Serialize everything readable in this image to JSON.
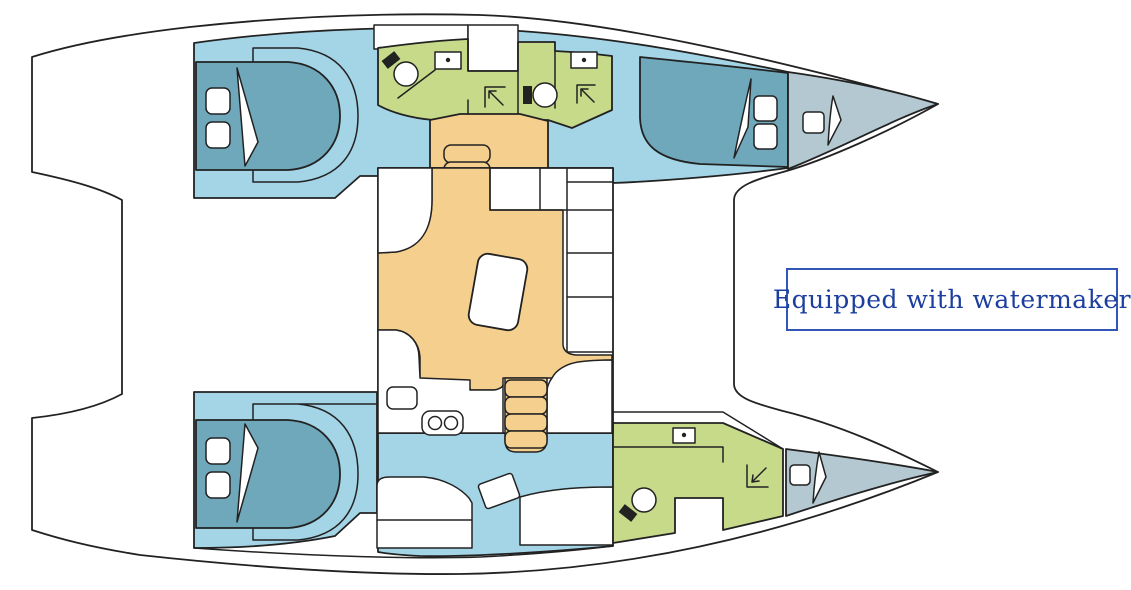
{
  "diagram": {
    "type": "boat-floor-plan",
    "subject": "Catamaran interior layout, top-down view, bows pointing right",
    "annotation": {
      "label": "Equipped with watermaker"
    },
    "palette": {
      "outline": "#222222",
      "hull_white": "#ffffff",
      "cabin_blue": "#a4d5e6",
      "bed_teal": "#6fa8ba",
      "bathroom_green": "#c7da8a",
      "salon_tan": "#f5cf8d",
      "bow_gray": "#b3c8d1",
      "label_text": "#1c3e9e",
      "label_border": "#3156b5"
    },
    "regions": {
      "port_hull": [
        "aft double cabin with berth and two pillows",
        "two bathrooms with toilet, washbasin and shower",
        "forward double cabin with berth and two pillows",
        "forepeak locker with hatch"
      ],
      "starboard_hull": [
        "aft double cabin with berth and two pillows",
        "corridor with desk and seat",
        "bathroom with toilet, washbasin and shower",
        "forepeak locker with hatch"
      ],
      "bridge_deck": [
        "saloon with chart table and L-shaped seating",
        "galley with twin sinks and fridge",
        "companionway stairs down to each hull",
        "aft cockpit recess",
        "foredeck between bows"
      ]
    }
  }
}
